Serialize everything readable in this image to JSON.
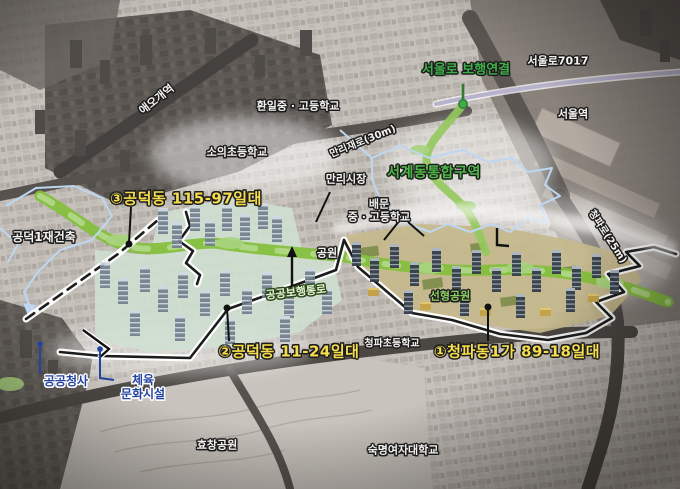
{
  "zones": {
    "zone1": {
      "label": "①청파동1가 89-18일대"
    },
    "zone2": {
      "label": "②공덕동 11-24일대"
    },
    "zone3": {
      "label": "③공덕동 115-97일대"
    },
    "seogye": {
      "label": "서계동통합구역"
    },
    "gongdeok1": {
      "label": "공덕1재건축"
    }
  },
  "transit": {
    "aeogae_station": "애오개역",
    "seoul_station": "서울역",
    "seoullo7017": "서울로7017",
    "seoullo_link": "서울로 보행연결"
  },
  "roads": {
    "manri": "만리재로(30m)",
    "cheongpa": "청파로(25m)"
  },
  "schools": {
    "hwanil": "환일중 · 고등학교",
    "soui": "소의초등학교",
    "baemun_line1": "배문",
    "baemun_line2": "중 · 고등학교",
    "cheongpa_elem": "청파초등학교",
    "sookmyung": "숙명여자대학교"
  },
  "parks": {
    "park": "공원",
    "linear_park": "선형공원",
    "hyochang": "효창공원",
    "ped_path": "공공보행통로"
  },
  "facilities": {
    "market": "만리시장",
    "public_office": "공공청사",
    "sports_line1": "체육",
    "sports_line2": "문화시설"
  },
  "colors": {
    "zone_label_yellow": "#f6dd4e",
    "green_accent": "#4db848",
    "corridor_green": "#8dc63f",
    "boundary_blue": "#bdd7f2",
    "facility_blue": "#2443a0",
    "outline_black": "#1c1c1c"
  }
}
